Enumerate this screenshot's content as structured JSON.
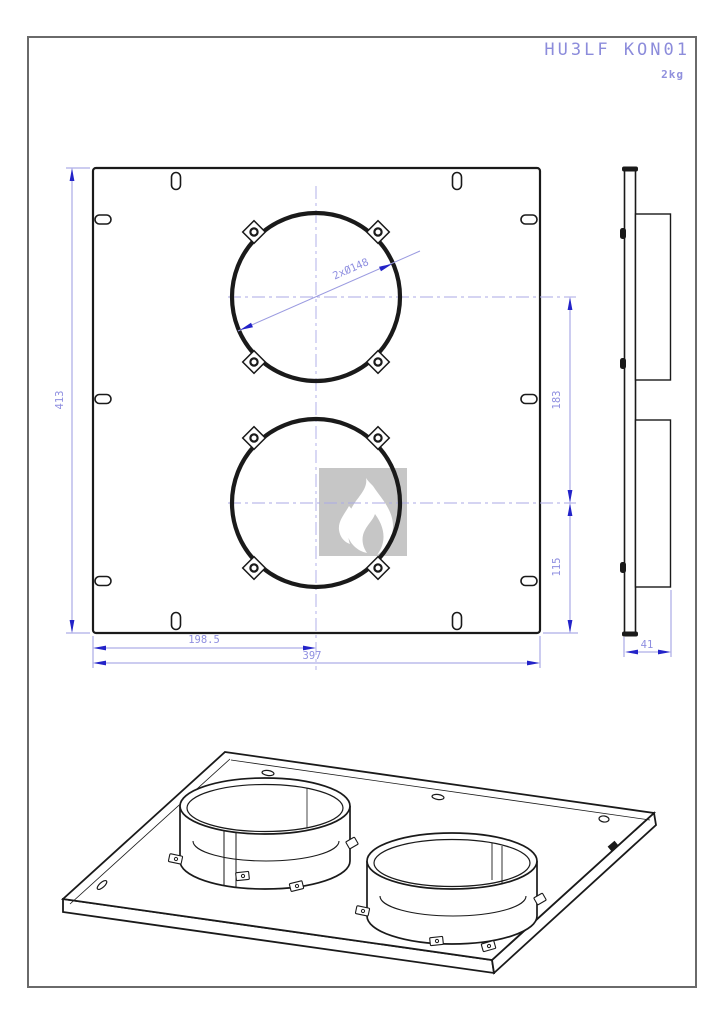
{
  "header": {
    "part_number": "HU3LF KON01",
    "weight": "2kg"
  },
  "dimensions": {
    "plate_height": "413",
    "plate_width": "397",
    "flange_center_x": "198.5",
    "flange_spacing": "183",
    "flange_bottom_offset": "115",
    "flange_diameter": "2xØ148",
    "total_depth": "41"
  },
  "watermark": {
    "icon": "flame-icon"
  },
  "colors": {
    "title_blue": "#8c8cdb",
    "dimension_blue": "#8f8fe0",
    "arrow_blue": "#2323c8",
    "line_black": "#1a1a1a",
    "frame_gray": "#6a6a6a",
    "watermark_gray": "#c6c6c6"
  }
}
